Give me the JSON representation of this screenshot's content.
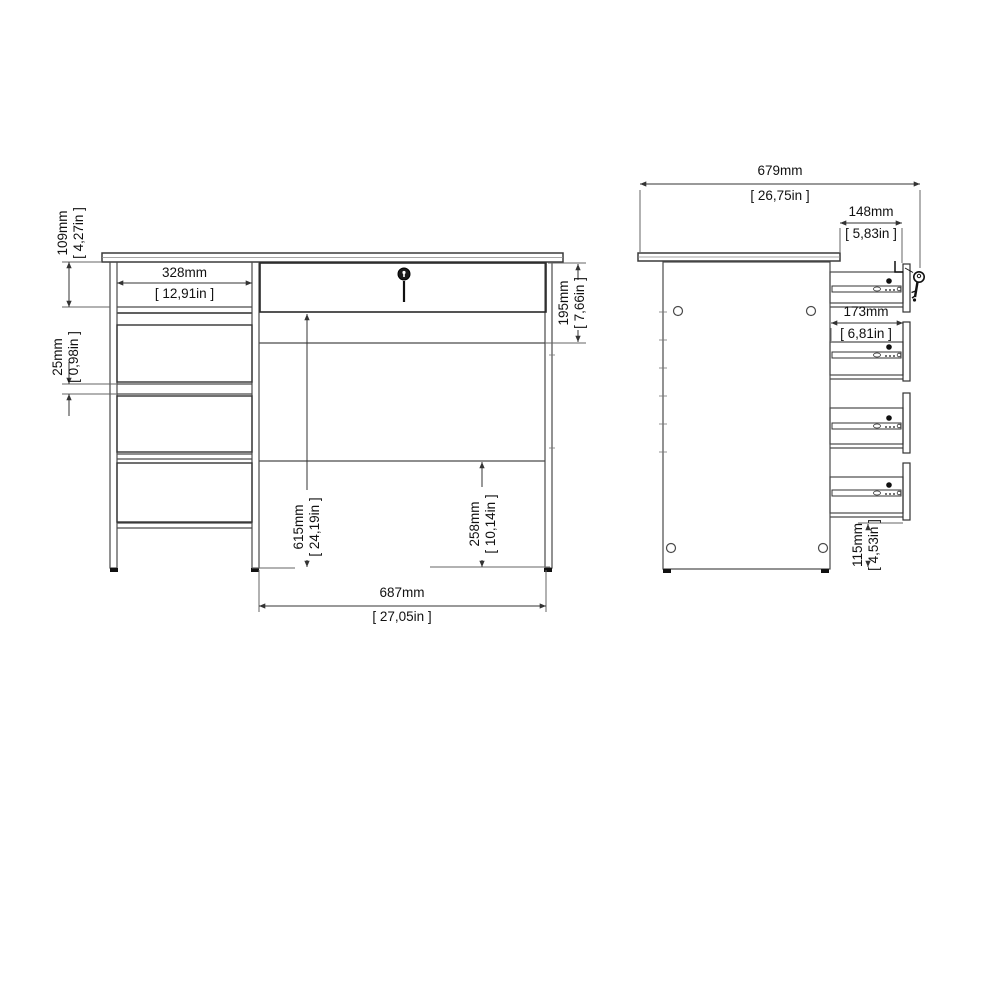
{
  "drawing_title": "desk technical drawing",
  "colors": {
    "background": "#ffffff",
    "furniture_line": "#4a4a4a",
    "drawer_box_line": "#333333",
    "dimension_line": "#333333",
    "extension_line": "#666666",
    "text": "#111111",
    "hardware_fill": "#111111"
  },
  "front_view": {
    "name": "front view",
    "dimensions": {
      "top_drawer_height": {
        "mm": "109mm",
        "inch": "[ 4,27in ]"
      },
      "drawer_gap": {
        "mm": "25mm",
        "inch": "[ 0,98in ]"
      },
      "pedestal_inner_width": {
        "mm": "328mm",
        "inch": "[ 12,91in ]"
      },
      "apron_height": {
        "mm": "195mm",
        "inch": "[ 7,66in ]"
      },
      "underdesk_height": {
        "mm": "615mm",
        "inch": "[ 24,19in ]"
      },
      "modesty_clearance": {
        "mm": "258mm",
        "inch": "[ 10,14in ]"
      },
      "kneehole_width": {
        "mm": "687mm",
        "inch": "[ 27,05in ]"
      }
    },
    "hardware": [
      "lock-icon"
    ]
  },
  "side_view": {
    "name": "side view",
    "dimensions": {
      "total_depth": {
        "mm": "679mm",
        "inch": "[ 26,75in ]"
      },
      "top_drawer_inner_depth": {
        "mm": "148mm",
        "inch": "[ 5,83in ]"
      },
      "drawer_inner_depth": {
        "mm": "173mm",
        "inch": "[ 6,81in ]"
      },
      "plinth_height": {
        "mm": "115mm",
        "inch": "[ 4,53in ]"
      }
    },
    "hardware": [
      "key-icon",
      "latch-icon",
      "drawer-slide",
      "cam-hole"
    ]
  }
}
